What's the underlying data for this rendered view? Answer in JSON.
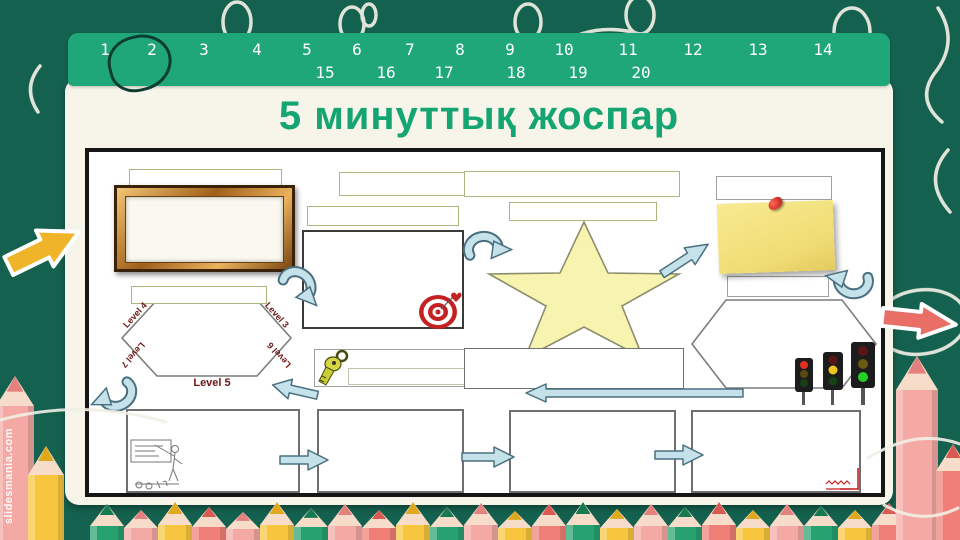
{
  "watermark": "slidesmania.com",
  "header": {
    "row1": [
      "1",
      "2",
      "3",
      "4",
      "5",
      "6",
      "7",
      "8",
      "9",
      "10",
      "11",
      "12",
      "13",
      "14"
    ],
    "row2": [
      "15",
      "16",
      "17",
      "18",
      "19",
      "20"
    ],
    "circled_number": "2"
  },
  "title": "5 минуттық жоспар",
  "diagram": {
    "hexagon_labels": [
      {
        "text": "Level 4"
      },
      {
        "text": "Level 3"
      },
      {
        "text": "Level 7"
      },
      {
        "text": "Level 5"
      },
      {
        "text": "Level 6"
      }
    ],
    "icons": [
      "picture-frame-icon",
      "target-icon",
      "star-icon",
      "sticky-note-icon",
      "key-icon",
      "traffic-light-icon",
      "teacher-sketch-icon",
      "curved-arrow-icon",
      "straight-arrow-icon"
    ]
  },
  "colors": {
    "background": "#15614f",
    "number_bar": "#1fa779",
    "card": "#f7f5ea",
    "title": "#15a572",
    "arrow_blue": "#c5e1ea",
    "star_yellow": "#f7f4b0",
    "note_yellow": "#f2e184",
    "level_label": "#6b1515",
    "target_red": "#c42222",
    "pencil_pink": "#f4a9a4",
    "pencil_yellow": "#f7c63e",
    "pencil_green": "#27a170",
    "pencil_salmon": "#f08077",
    "decor_arrow_yellow": "#f0b429",
    "decor_arrow_red": "#e86e66"
  }
}
